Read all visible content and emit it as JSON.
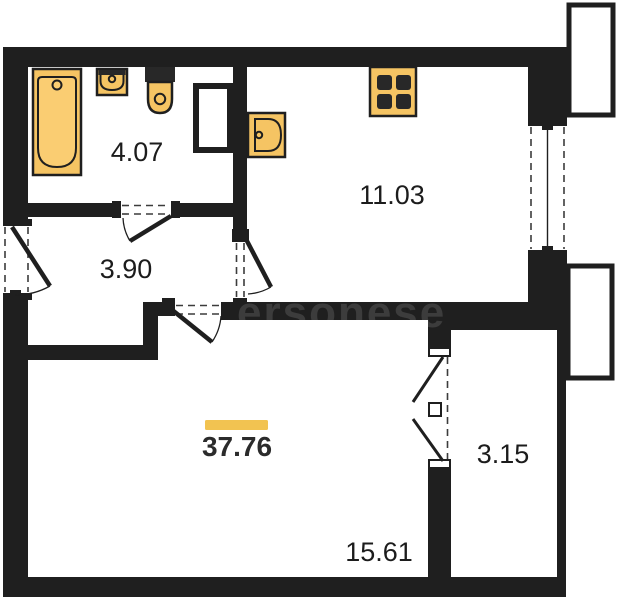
{
  "plan": {
    "type": "apartment-floor-plan",
    "rooms": [
      {
        "name": "bathroom",
        "area": "4.07"
      },
      {
        "name": "kitchen",
        "area": "11.03"
      },
      {
        "name": "hallway",
        "area": "3.90"
      },
      {
        "name": "living-room",
        "area": "15.61"
      },
      {
        "name": "loggia",
        "area": "3.15"
      }
    ],
    "total_area": "37.76",
    "watermark": "ersonese",
    "fixtures": [
      "bathtub",
      "sink",
      "toilet",
      "kitchen-sink",
      "stove"
    ]
  },
  "colors": {
    "wall": "#1f1f1f",
    "background": "#ffffff",
    "fixture": "#f5c463",
    "fixture-light": "#facd72",
    "accent": "#f2c351"
  }
}
